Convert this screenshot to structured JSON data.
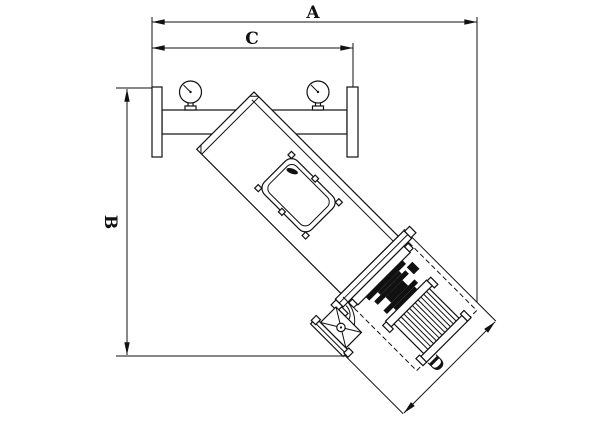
{
  "drawing": {
    "title": "Y-type inclined strainer technical outline drawing",
    "dimension_labels": {
      "a": "A",
      "b": "B",
      "c": "C",
      "d": "D"
    },
    "colors": {
      "line": "#111111",
      "background": "#ffffff"
    },
    "parts": [
      "left-pipe-flange",
      "right-pipe-flange",
      "inlet-outlet-pipe",
      "pressure-gauge-left",
      "pressure-gauge-right",
      "inclined-strainer-body",
      "access-panel",
      "end-flange",
      "drive-coupling",
      "motor-with-fins",
      "drain-elbow",
      "drain-valve",
      "withdrawal-envelope-dashed"
    ]
  }
}
